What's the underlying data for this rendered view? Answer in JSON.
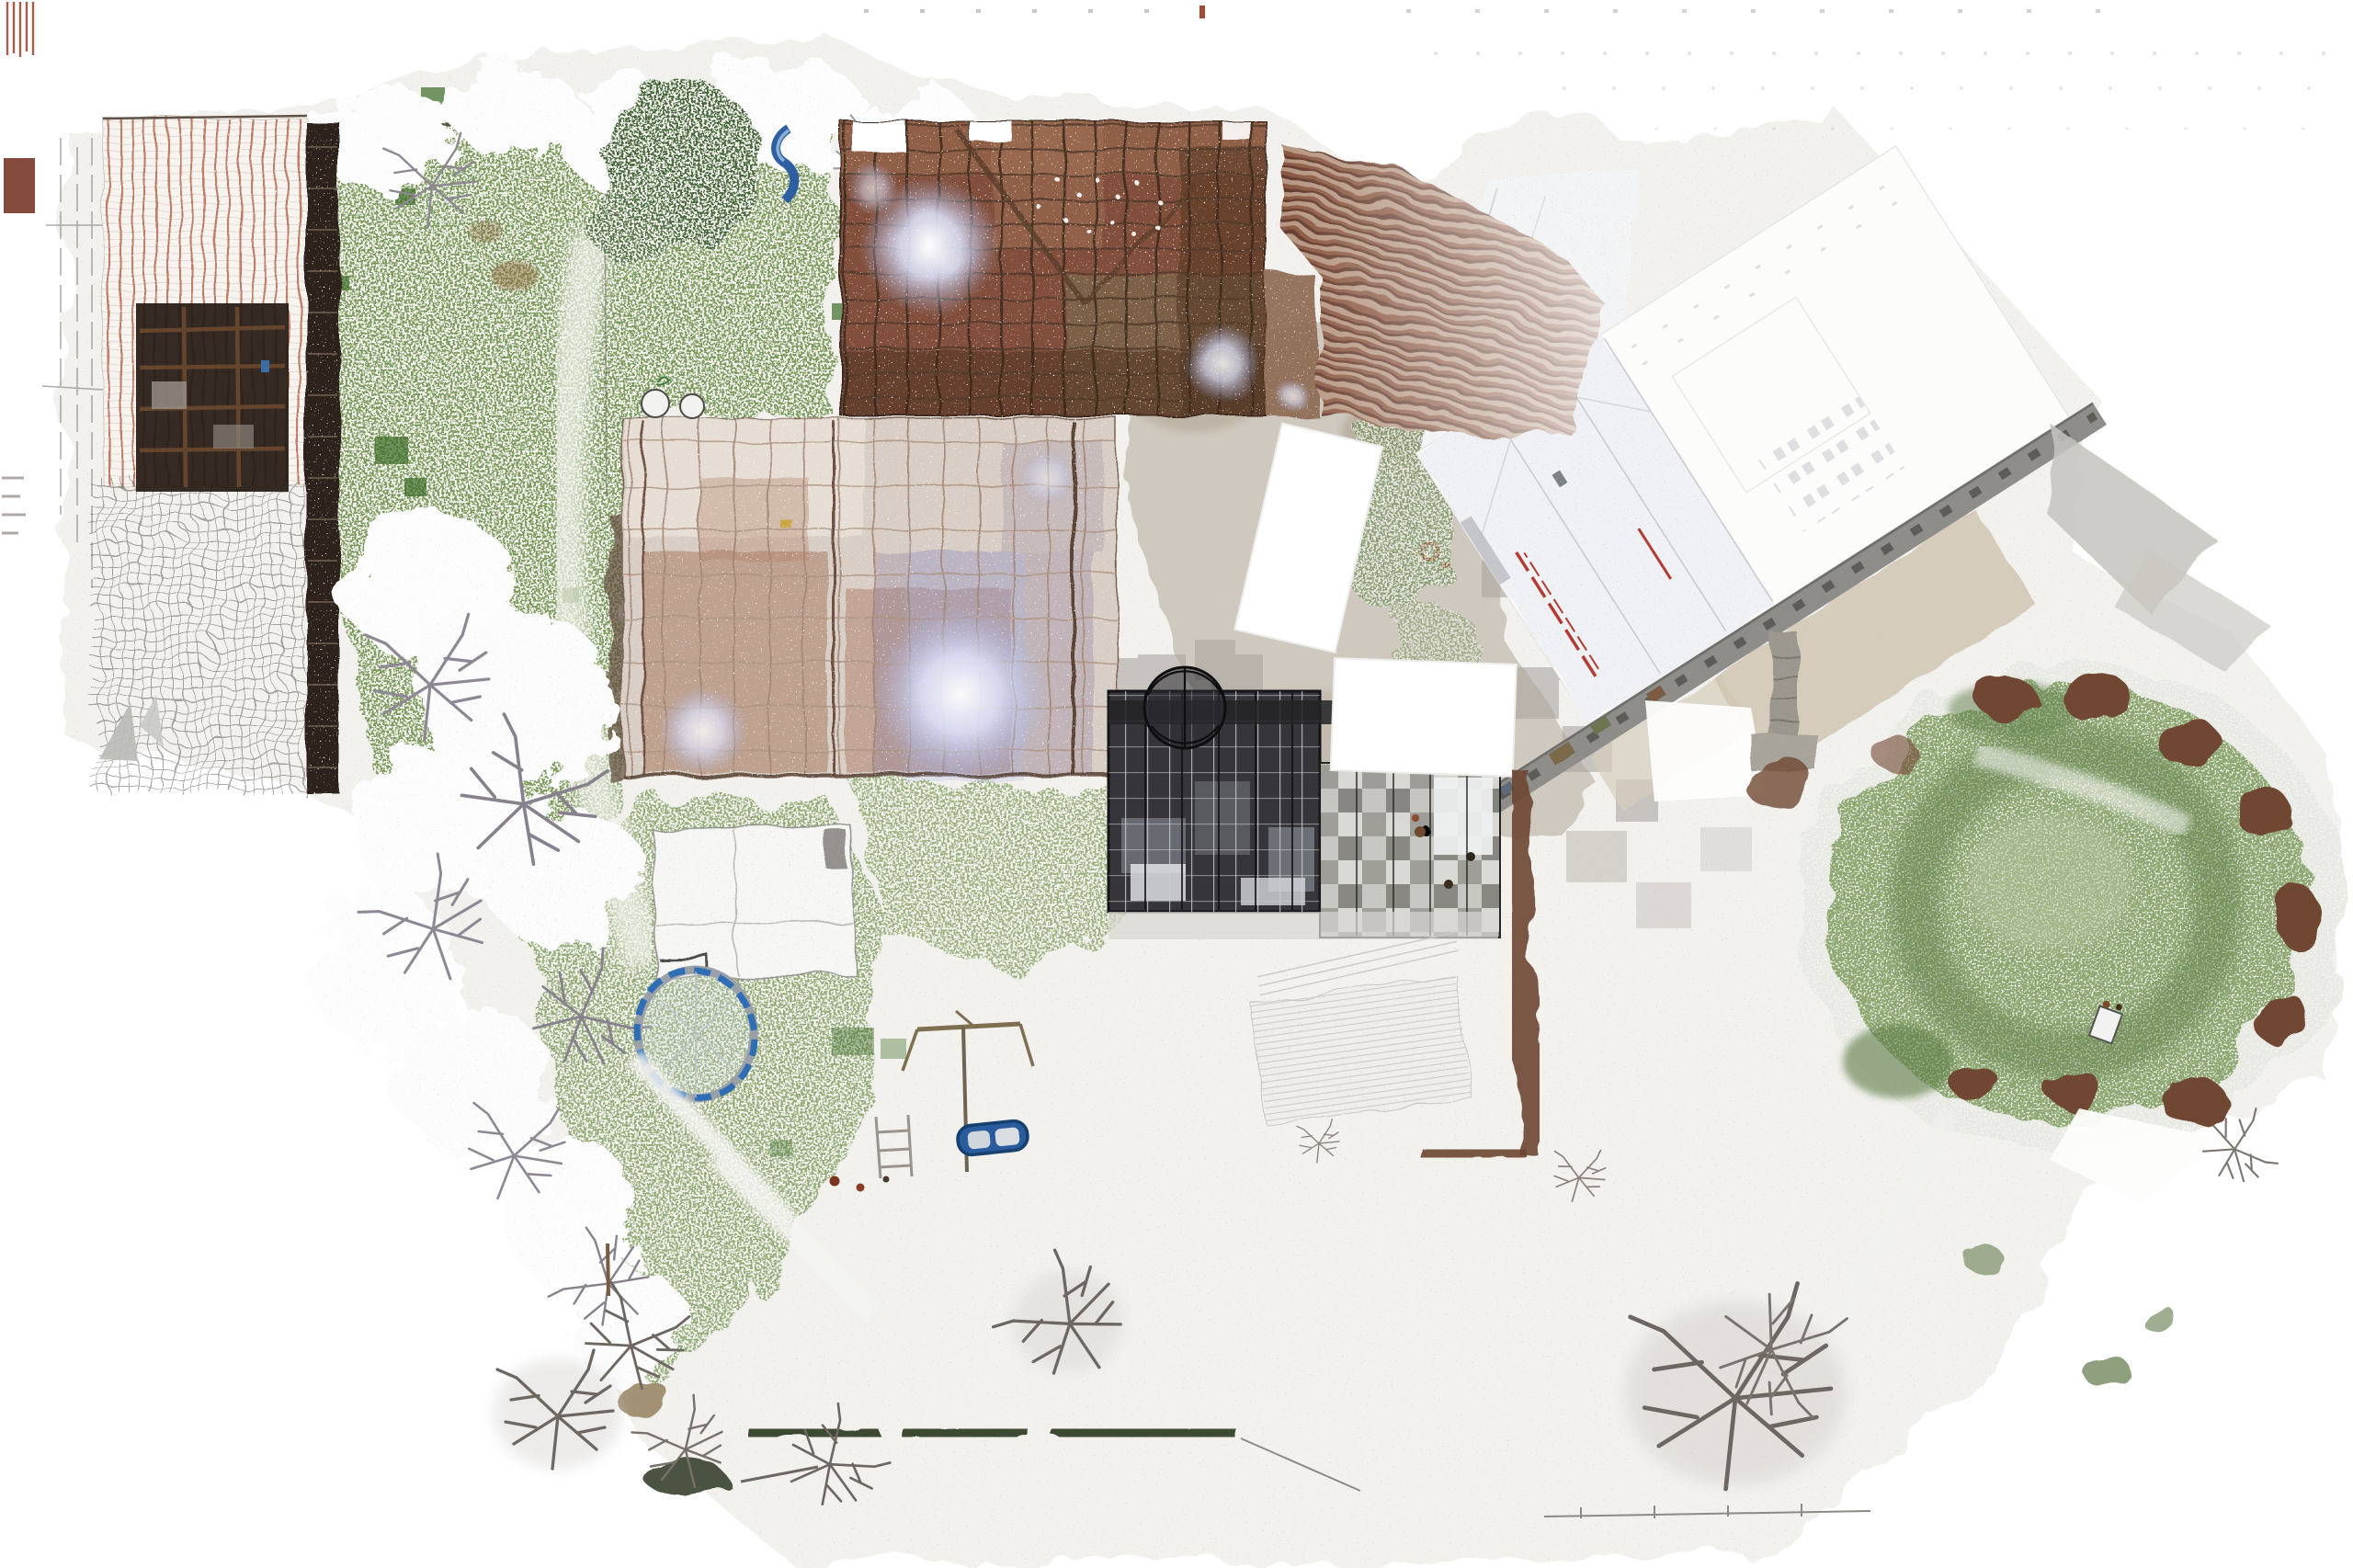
{
  "scene": {
    "title": "Aerial point-cloud orthophoto — farm site in light snow",
    "type": "top-down orthographic LiDAR / photogrammetry point cloud",
    "season": "winter, light snow dusting",
    "background": "#ffffff"
  },
  "palette": {
    "snow_wash": "#f1f0ec",
    "wash_speck": "#c9ccc0",
    "grass": "#7d9b5e",
    "grass_light": "#87a168",
    "lawn": "#8fa873",
    "lawn_ring": "#5f7d48",
    "canopy_dark": "#4a673c",
    "frost": "#e9e8ee",
    "rust_roof": "#82503c",
    "washed_roof": "#d9cec5",
    "tile_stripe": "#b06045",
    "timber_dark": "#2e241b",
    "glass_dark": "#35353a",
    "hedge_brown": "#6d4530",
    "hedge_dark_green": "#3d4a33",
    "road_gray": "#8e8d8a",
    "path_gray": "#9b978f",
    "apron_tan": "#cdc2ae",
    "trampoline_blue": "#2f6db5",
    "boat_blue": "#2a5b9c",
    "slide_blue": "#2d5fa2",
    "accent_red": "#b23c33",
    "bare_tree_gray": "#6e6761",
    "white_tarp": "#ffffff"
  },
  "features": [
    {
      "id": "ground-wash",
      "label": "scanned ground footprint with sparse gray speckle",
      "near": [
        1300,
        900
      ]
    },
    {
      "id": "garden",
      "label": "snow-dusted green garden lawn",
      "near": [
        640,
        560
      ]
    },
    {
      "id": "frost-trees-top",
      "label": "frosted white tree canopies along north fence",
      "near": [
        700,
        140
      ]
    },
    {
      "id": "dark-canopy",
      "label": "dark evergreen canopy",
      "near": [
        745,
        180
      ]
    },
    {
      "id": "frost-cluster-left",
      "label": "large frosted tree cluster west side",
      "near": [
        540,
        950
      ]
    },
    {
      "id": "barn-topleft",
      "label": "tiled barn roof with red ridge stripes and mesh section",
      "near": [
        230,
        480
      ]
    },
    {
      "id": "barn-opening",
      "label": "opening in roof showing timber interior",
      "near": [
        230,
        430
      ]
    },
    {
      "id": "barn-topcenter",
      "label": "exposed rust-brown timber/brick barn roof",
      "near": [
        1145,
        290
      ]
    },
    {
      "id": "ridged-roof",
      "label": "rusty ridged roof wing, snow dusted",
      "near": [
        1570,
        310
      ]
    },
    {
      "id": "barn-central",
      "label": "washed-out scanned barn roof with grid of beams",
      "near": [
        945,
        650
      ]
    },
    {
      "id": "annex",
      "label": "white annex building",
      "near": [
        820,
        980
      ]
    },
    {
      "id": "white-discs",
      "label": "two round white tables",
      "near": [
        733,
        440
      ]
    },
    {
      "id": "courtyard",
      "label": "mottled gravel courtyard with LOD blocks",
      "near": [
        1450,
        650
      ]
    },
    {
      "id": "white-tarps",
      "label": "white unscanned tarp/roof rectangles",
      "near": [
        1500,
        640
      ]
    },
    {
      "id": "glass-building",
      "label": "dark glass-roofed building",
      "near": [
        1320,
        870
      ]
    },
    {
      "id": "dome",
      "label": "domed glass vault",
      "near": [
        1289,
        770
      ]
    },
    {
      "id": "checkered-roof",
      "label": "gray checkered roof section",
      "near": [
        1530,
        925
      ]
    },
    {
      "id": "hedge-east",
      "label": "brown hedge strip",
      "near": [
        1655,
        1050
      ]
    },
    {
      "id": "terrace",
      "label": "snow-covered terrace decking",
      "near": [
        1480,
        1140
      ]
    },
    {
      "id": "diagonal-building",
      "label": "white diagonal building complex with red handrails",
      "near": [
        1900,
        400
      ]
    },
    {
      "id": "access-road",
      "label": "gray access road with dashed joints",
      "near": [
        1925,
        660
      ]
    },
    {
      "id": "footpath",
      "label": "gray footpath to lawn",
      "near": [
        1941,
        750
      ]
    },
    {
      "id": "apron",
      "label": "tan gravel apron",
      "near": [
        2050,
        620
      ]
    },
    {
      "id": "lawn-circle",
      "label": "large circular green lawn",
      "near": [
        2253,
        985
      ]
    },
    {
      "id": "lawn-shrubs",
      "label": "brown shrub ring around lawn",
      "near": [
        2400,
        950
      ]
    },
    {
      "id": "trampoline",
      "label": "blue trampoline ring",
      "near": [
        757,
        1125
      ]
    },
    {
      "id": "slide",
      "label": "blue playground slide",
      "near": [
        865,
        160
      ]
    },
    {
      "id": "swing",
      "label": "swing frame and pole",
      "near": [
        1050,
        1150
      ]
    },
    {
      "id": "ladder",
      "label": "small ladder / bench",
      "near": [
        970,
        1245
      ]
    },
    {
      "id": "boat",
      "label": "blue rowing boat",
      "near": [
        1080,
        1238
      ]
    },
    {
      "id": "mud-patch",
      "label": "brown mud patch",
      "near": [
        700,
        1522
      ]
    },
    {
      "id": "bare-trees",
      "label": "bare winter trees",
      "near": [
        1888,
        1516
      ]
    },
    {
      "id": "bottom-hedge",
      "label": "dark green hedge line",
      "near": [
        1050,
        1565
      ]
    },
    {
      "id": "fence",
      "label": "thin garden fence lines",
      "near": [
        1850,
        1648
      ]
    },
    {
      "id": "edge-dashes",
      "label": "scan artifact dash rows at top edge",
      "near": [
        1700,
        14
      ]
    }
  ]
}
